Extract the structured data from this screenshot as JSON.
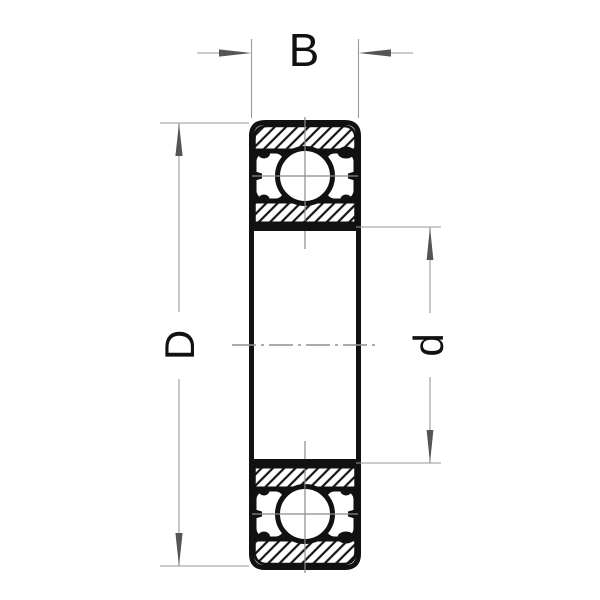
{
  "diagram": {
    "kind": "ball-bearing-cross-section",
    "dimensions": {
      "width": {
        "label": "B"
      },
      "outer_diameter": {
        "label": "D"
      },
      "bore_diameter": {
        "label": "d"
      }
    },
    "colors": {
      "background": "#ffffff",
      "outline": "#111111",
      "hatch_line": "#141414",
      "dimension_line": "#9a9a9a",
      "arrowhead": "#555555",
      "centerline": "#8f8f8f",
      "label_text": "#111111"
    }
  }
}
